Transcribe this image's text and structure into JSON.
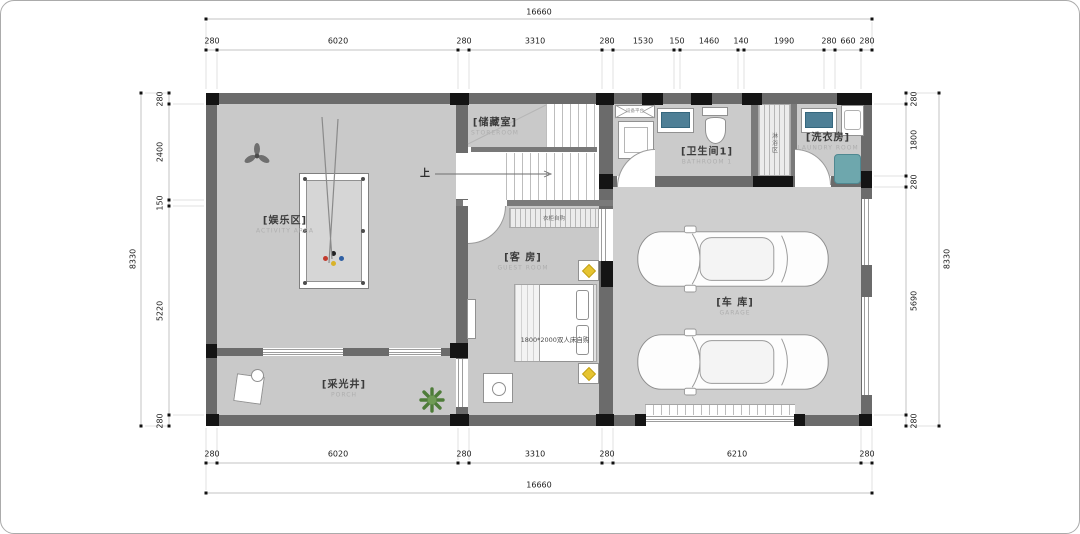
{
  "dims": {
    "top_total": "16660",
    "bottom_total": "16660",
    "left_total": "8330",
    "right_total": "8330",
    "top": [
      "280",
      "6020",
      "280",
      "3310",
      "280",
      "1530",
      "150",
      "1460",
      "140",
      "1990",
      "280",
      "660",
      "280"
    ],
    "bottom": [
      "280",
      "6020",
      "280",
      "3310",
      "280",
      "6210",
      "280"
    ],
    "left": [
      "280",
      "2400",
      "150",
      "5220",
      "280"
    ],
    "right": [
      "280",
      "1800",
      "280",
      "5690",
      "280"
    ]
  },
  "rooms": {
    "entertainment": {
      "name": "[娱乐区]",
      "en": "ACTIVITY AREA"
    },
    "storage": {
      "name": "[储藏室]",
      "en": "STOREROOM"
    },
    "bathroom": {
      "name": "[卫生间1]",
      "en": "BATHROOM 1"
    },
    "laundry": {
      "name": "[洗衣房]",
      "en": "LAUNDRY ROOM"
    },
    "guest": {
      "name": "[客 房]",
      "en": "GUEST ROOM"
    },
    "garage": {
      "name": "[车 库]",
      "en": "GARAGE"
    },
    "lightwell": {
      "name": "[采光井]",
      "en": "PORCH"
    }
  },
  "annotations": {
    "up": "上",
    "bed": "1800*2000双人床自购",
    "wardrobe": "衣柜自购",
    "shaft": "淋浴区",
    "vent": "设备平台"
  },
  "colors": {
    "wall": "#6b6b6b",
    "column": "#141414",
    "floor": "#c9c9c9",
    "basin": "#4e7f96",
    "washer": "#6ea7ad",
    "lamp": "#e6c431",
    "plant": "#4e7c39"
  }
}
